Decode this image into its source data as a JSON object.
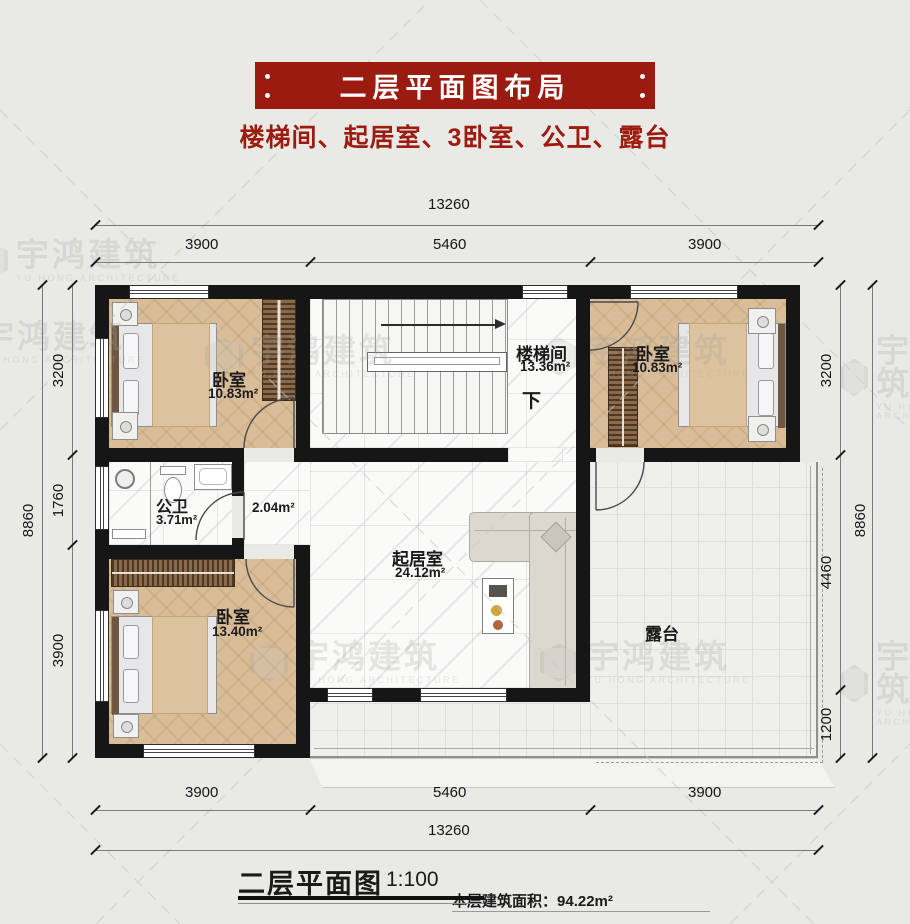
{
  "header": {
    "title": "二层平面图布局",
    "subtitle": "楼梯间、起居室、3卧室、公卫、露台"
  },
  "dims": {
    "top_total": "13260",
    "top_segs": [
      "3900",
      "5460",
      "3900"
    ],
    "bottom_total": "13260",
    "bottom_segs": [
      "3900",
      "5460",
      "3900"
    ],
    "left_total": "8860",
    "left_segs": [
      "3200",
      "1760",
      "3900"
    ],
    "right_total": "8860",
    "right_segs": [
      "3200",
      "4460",
      "1200"
    ]
  },
  "rooms": {
    "bedroom_tl": {
      "name": "卧室",
      "area": "10.83m²"
    },
    "bedroom_tr": {
      "name": "卧室",
      "area": "10.83m²"
    },
    "bedroom_bl": {
      "name": "卧室",
      "area": "13.40m²"
    },
    "stairwell": {
      "name": "楼梯间",
      "area": "13.36m²",
      "down": "下"
    },
    "bathroom": {
      "name": "公卫",
      "area": "3.71m²"
    },
    "hall": {
      "area": "2.04m²"
    },
    "living": {
      "name": "起居室",
      "area": "24.12m²"
    },
    "terrace": {
      "name": "露台"
    }
  },
  "footer": {
    "caption": "二层平面图",
    "scale": "1:100",
    "area_label": "本层建筑面积：",
    "area_value": "94.22m²"
  },
  "watermark": {
    "cn": "宇鸿建筑",
    "en": "YU HONG ARCHITECTURE"
  },
  "colors": {
    "banner": "#9c1b10",
    "subtitle_red": "#9e1b10",
    "wall": "#161616"
  }
}
